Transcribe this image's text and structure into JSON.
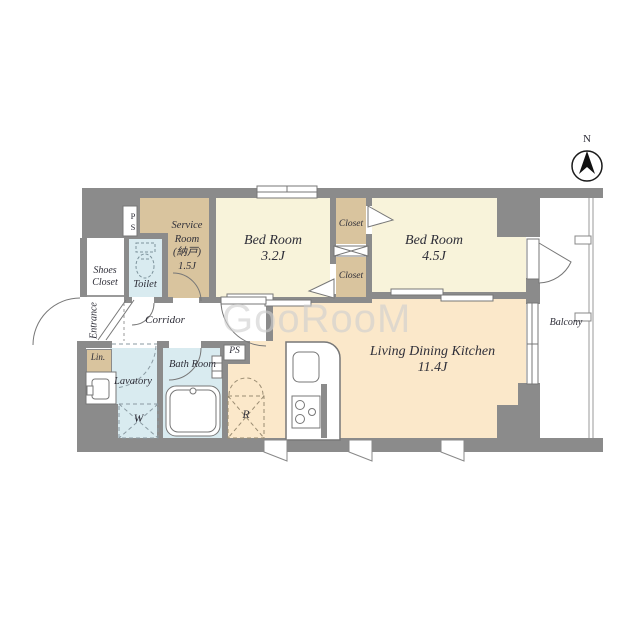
{
  "watermark": "GooRooM",
  "compass": {
    "north": "N"
  },
  "labels": {
    "service_room": {
      "l1": "Service",
      "l2": "Room",
      "l3": "(納戸)",
      "l4": "1.5J"
    },
    "bedroom_small": {
      "name": "Bed Room",
      "size": "3.2J"
    },
    "bedroom_large": {
      "name": "Bed Room",
      "size": "4.5J"
    },
    "ldk": {
      "name": "Living Dining Kitchen",
      "size": "11.4J"
    },
    "closet_upper": "Closet",
    "closet_lower": "Closet",
    "toilet": "Toilet",
    "shoes_closet": {
      "l1": "Shoes",
      "l2": "Closet"
    },
    "entrance": "Entrance",
    "corridor": "Corridor",
    "linen": "Lin.",
    "lavatory": "Lavatory",
    "bathroom": "Bath Room",
    "balcony": "Balcony",
    "ps_top": "PS",
    "ps_bottom": "PS",
    "washing_machine": "W",
    "refrigerator": "R"
  },
  "colors": {
    "wall": "#8b8b8b",
    "bedroom_floor": "#f8f3da",
    "storage_floor": "#d9c49e",
    "ldk_floor": "#fbe8ca",
    "wet_area_floor": "#d9ebf0",
    "line": "#777777",
    "text": "#2e2e38",
    "watermark": "#d3d3d3"
  }
}
